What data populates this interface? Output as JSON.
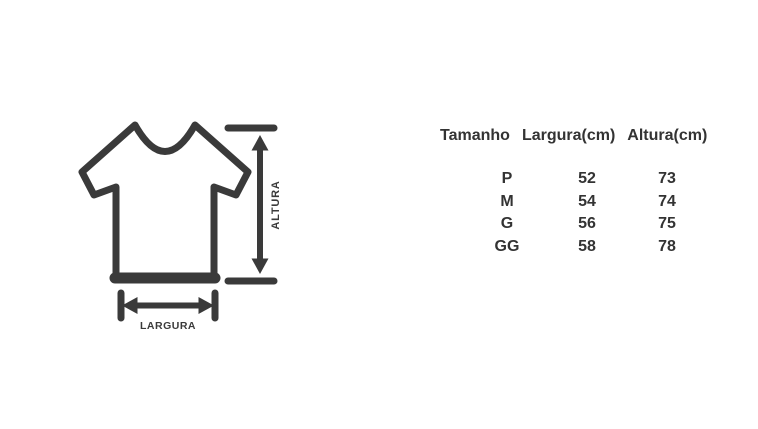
{
  "page": {
    "background_color": "#ffffff",
    "text_color": "#333333"
  },
  "diagram": {
    "stroke_color": "#3a3a3a",
    "height_label": "ALTURA",
    "width_label": "LARGURA"
  },
  "size_table": {
    "headers": [
      "Tamanho",
      "Largura(cm)",
      "Altura(cm)"
    ],
    "rows": [
      {
        "tamanho": "P",
        "largura": "52",
        "altura": "73"
      },
      {
        "tamanho": "M",
        "largura": "54",
        "altura": "74"
      },
      {
        "tamanho": "G",
        "largura": "56",
        "altura": "75"
      },
      {
        "tamanho": "GG",
        "largura": "58",
        "altura": "78"
      }
    ]
  },
  "chart_data": {
    "type": "table",
    "title": "",
    "columns": [
      "Tamanho",
      "Largura(cm)",
      "Altura(cm)"
    ],
    "rows": [
      [
        "P",
        52,
        73
      ],
      [
        "M",
        54,
        74
      ],
      [
        "G",
        56,
        75
      ],
      [
        "GG",
        58,
        78
      ]
    ]
  }
}
